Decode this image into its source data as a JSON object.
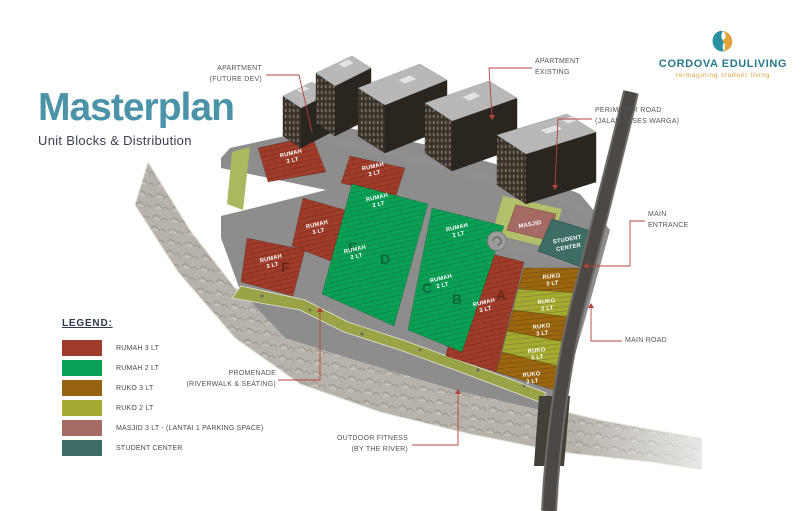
{
  "header": {
    "title": "Masterplan",
    "subtitle": "Unit Blocks & Distribution"
  },
  "logo": {
    "name": "CORDOVA EDULIVING",
    "tagline": "reimagining student living"
  },
  "legend": {
    "title": "LEGEND:",
    "items": [
      {
        "label": "RUMAH 3 LT",
        "color": "#9e3b2b"
      },
      {
        "label": "RUMAH 2 LT",
        "color": "#0aa157"
      },
      {
        "label": "RUKO 3 LT",
        "color": "#96620f"
      },
      {
        "label": "RUKO 2 LT",
        "color": "#a3aa31"
      },
      {
        "label": "MASJID 3 LT - (LANTAI 1 PARKING SPACE)",
        "color": "#a56a64"
      },
      {
        "label": "STUDENT CENTER",
        "color": "#3d6d64"
      }
    ]
  },
  "callouts": {
    "apartment_future": {
      "line1": "APARTMENT",
      "line2": "(FUTURE DEV)"
    },
    "apartment_existing": {
      "line1": "APARTMENT",
      "line2": "EXISTING"
    },
    "perimeter_road": {
      "line1": "PERIMETER ROAD",
      "line2": "(JALAN AKSES WARGA)"
    },
    "main_entrance": {
      "line1": "MAIN",
      "line2": "ENTRANCE"
    },
    "main_road": {
      "label": "MAIN ROAD"
    },
    "promenade": {
      "line1": "PROMENADE",
      "line2": "(RIVERWALK & SEATING)"
    },
    "outdoor_fitness": {
      "line1": "OUTDOOR FITNESS",
      "line2": "(BY THE RIVER)"
    }
  },
  "site": {
    "labels": {
      "rumah": "RUMAH",
      "ruko": "RUKO",
      "lt3": "3 LT",
      "lt2": "2 LT",
      "masjid": "MASJID",
      "student1": "STUDENT",
      "student2": "CENTER"
    },
    "block_letters": {
      "a": "A",
      "b": "B",
      "c": "C",
      "d": "D",
      "e": "E",
      "f": "F"
    }
  },
  "colors": {
    "title": "#4a93a8",
    "subtitle": "#39404f",
    "callout_text": "#555555",
    "leader_line": "#b0443b",
    "logo_teal": "#27788c",
    "logo_gold": "#e09b3a",
    "river": "#b7b3ac",
    "road": "#8f8f8f",
    "main_road": "#4b4845",
    "promenade": "#9aa348"
  }
}
